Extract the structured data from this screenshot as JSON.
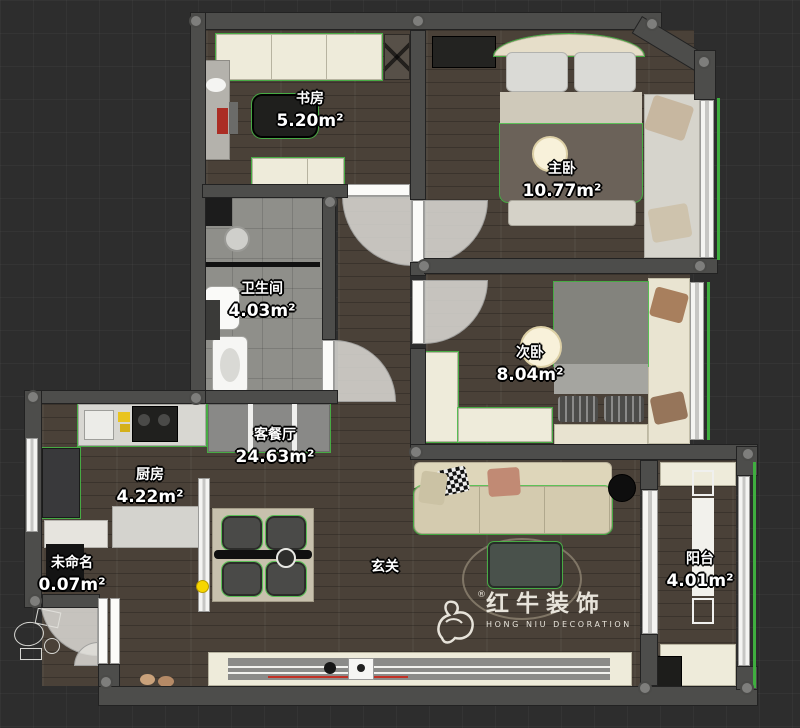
{
  "rooms": [
    {
      "id": "study",
      "name": "书房",
      "area": "5.20m²"
    },
    {
      "id": "master-bedroom",
      "name": "主卧",
      "area": "10.77m²"
    },
    {
      "id": "bathroom",
      "name": "卫生间",
      "area": "4.03m²"
    },
    {
      "id": "second-bedroom",
      "name": "次卧",
      "area": "8.04m²"
    },
    {
      "id": "living-dining",
      "name": "客餐厅",
      "area": "24.63m²"
    },
    {
      "id": "kitchen",
      "name": "厨房",
      "area": "4.22m²"
    },
    {
      "id": "unnamed",
      "name": "未命名",
      "area": "0.07m²"
    },
    {
      "id": "hallway",
      "name": "玄关",
      "area": ""
    },
    {
      "id": "balcony",
      "name": "阳台",
      "area": "4.01m²"
    }
  ],
  "watermark": {
    "brand": "红牛装饰",
    "sub": "HONG NIU DECORATION",
    "registered": "®"
  },
  "colors": {
    "background": "#2d2d2d",
    "wall": "#4d4d4b",
    "wood_floor": "#4a4138",
    "tile_floor": "#8f8f8a",
    "cabinet_cream": "#eeebda",
    "selection_green": "#3fae3f",
    "accent_yellow": "#f7d600",
    "label_text": "#ffffff",
    "watermark": "#f3f0e7"
  }
}
